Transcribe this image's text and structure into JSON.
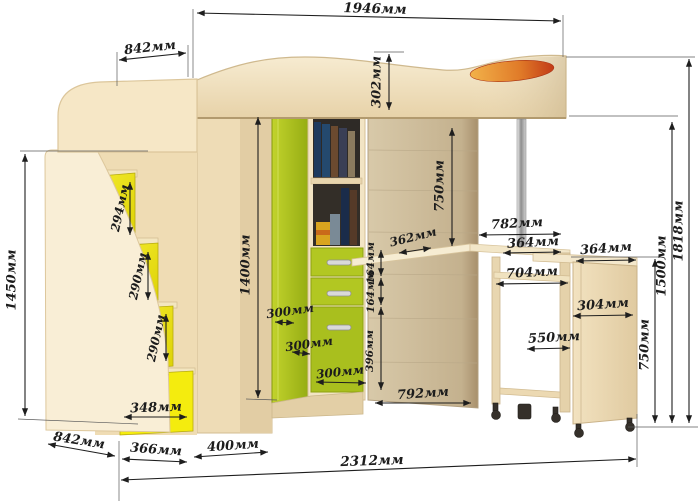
{
  "diagram": {
    "kind": "furniture-dimension-drawing",
    "unit": "мм",
    "labels": {
      "top_width": "1946мм",
      "top_left_width": "842мм",
      "bed_panel_height": "302мм",
      "stairs_height": "1450мм",
      "step1_height": "294мм",
      "step2_height": "290мм",
      "step3_height": "290мм",
      "step_drawer_width": "348мм",
      "bottom_left_depth": "842мм",
      "bottom_stairs_width": "366мм",
      "bottom_wardrobe_width": "400мм",
      "wardrobe_height": "1400мм",
      "underbed_clearance": "750мм",
      "desk_corner_depth": "362мм",
      "drawer1_height": "164мм",
      "drawer2_height": "164мм",
      "drawer3_height": "396мм",
      "corner_face_a": "300мм",
      "corner_face_b": "300мм",
      "corner_face_c": "300мм",
      "back_panel_width": "792мм",
      "total_width": "2312мм",
      "desk_top_width": "782мм",
      "desk_section_width": "364мм",
      "pedestal_top_width": "364мм",
      "desk_inner_width": "704мм",
      "pedestal_depth": "304мм",
      "desk_opening_width": "550мм",
      "desk_height": "750мм",
      "bed_base_height": "1500мм",
      "total_height": "1818мм"
    },
    "colors": {
      "background": "#ffffff",
      "wood_light": "#f6ead0",
      "wood_mid": "#eedcb6",
      "wood_dark": "#cdbc9c",
      "lime_green": "#b2c722",
      "step_yellow": "#eee211",
      "accent_orange": "#e08a30",
      "chrome_pole": "#c8c8c8",
      "dimension_line": "#1e1e1e"
    }
  }
}
